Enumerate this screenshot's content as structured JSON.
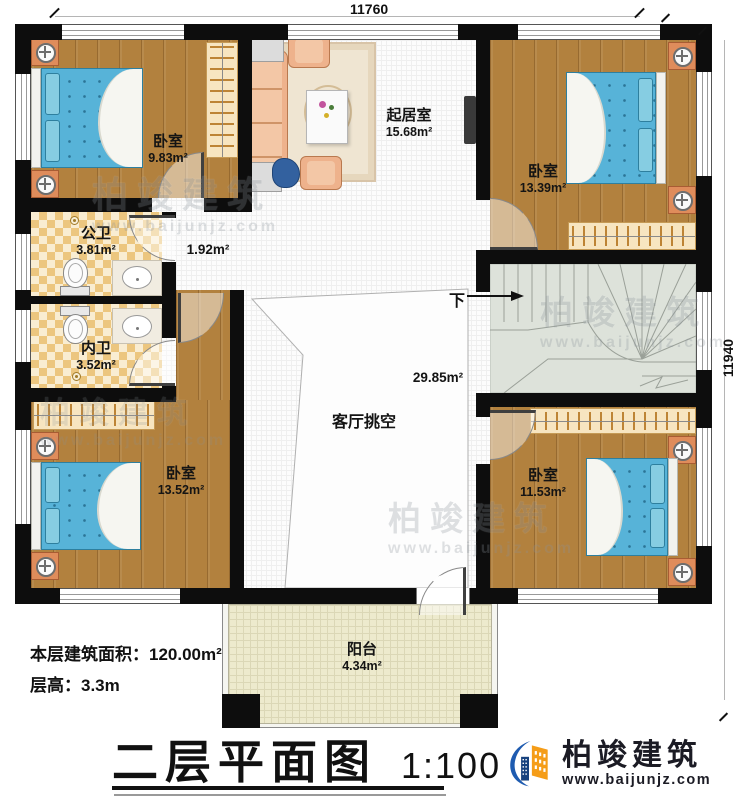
{
  "dimensions": {
    "top": "11760",
    "right": "11940"
  },
  "rooms": {
    "bedroom_tl": {
      "name": "卧室",
      "area": "9.83m²"
    },
    "living": {
      "name": "起居室",
      "area": "15.68m²"
    },
    "bedroom_tr": {
      "name": "卧室",
      "area": "13.39m²"
    },
    "bath_public": {
      "name": "公卫",
      "area": "3.81m²"
    },
    "bath_private": {
      "name": "内卫",
      "area": "3.52m²"
    },
    "hall": {
      "area": "1.92m²"
    },
    "void": {
      "name": "客厅挑空",
      "area": "29.85m²"
    },
    "bedroom_bl": {
      "name": "卧室",
      "area": "13.52m²"
    },
    "bedroom_br": {
      "name": "卧室",
      "area": "11.53m²"
    },
    "balcony": {
      "name": "阳台",
      "area": "4.34m²"
    }
  },
  "stairs": {
    "down_label": "下"
  },
  "info": {
    "floor_area": "本层建筑面积：120.00m²",
    "floor_height": "层高：3.3m"
  },
  "title": {
    "text": "二层平面图",
    "scale": "1:100"
  },
  "brand": {
    "name": "柏竣建筑",
    "url": "www.baijunjz.com"
  }
}
